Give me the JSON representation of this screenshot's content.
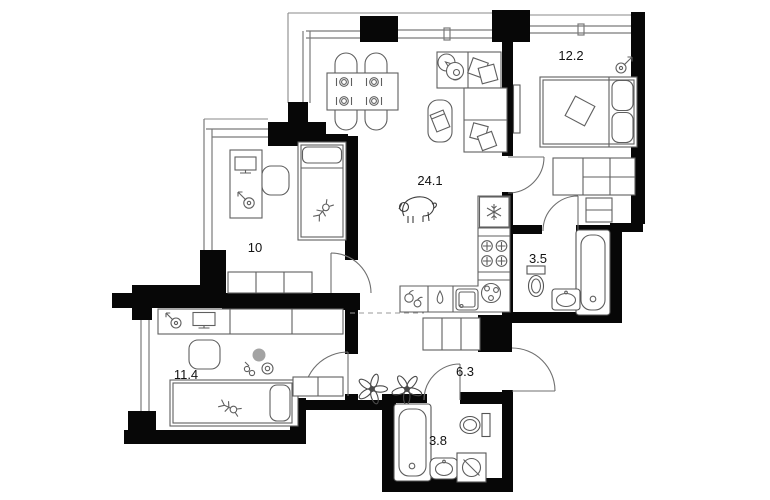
{
  "plan": {
    "type": "apartment-floor-plan",
    "rooms": [
      {
        "name": "living-room-kitchen",
        "area": "24.1"
      },
      {
        "name": "bedroom",
        "area": "12.2"
      },
      {
        "name": "bathroom-ensuite",
        "area": "3.5"
      },
      {
        "name": "kids-room",
        "area": "10"
      },
      {
        "name": "kids-room-2",
        "area": "11.4"
      },
      {
        "name": "hallway",
        "area": "6.3"
      },
      {
        "name": "bathroom",
        "area": "3.8"
      }
    ],
    "colors": {
      "walls": "#070707",
      "furniture_lines": "#5f5f5f",
      "window_lines": "#7a7a7a",
      "background": "#ffffff"
    },
    "icons": [
      "double-bed",
      "single-bed",
      "sofa",
      "coffee-table",
      "dining-table",
      "chair",
      "tv",
      "fridge-snowflake",
      "stove-burners",
      "kitchen-sink",
      "water-drop",
      "fruit",
      "bathtub",
      "toilet",
      "washbasin",
      "washing-machine",
      "wardrobe",
      "desk",
      "monitor",
      "desk-lamp",
      "dog",
      "cat",
      "toy-figure",
      "flower",
      "place-setting"
    ]
  }
}
